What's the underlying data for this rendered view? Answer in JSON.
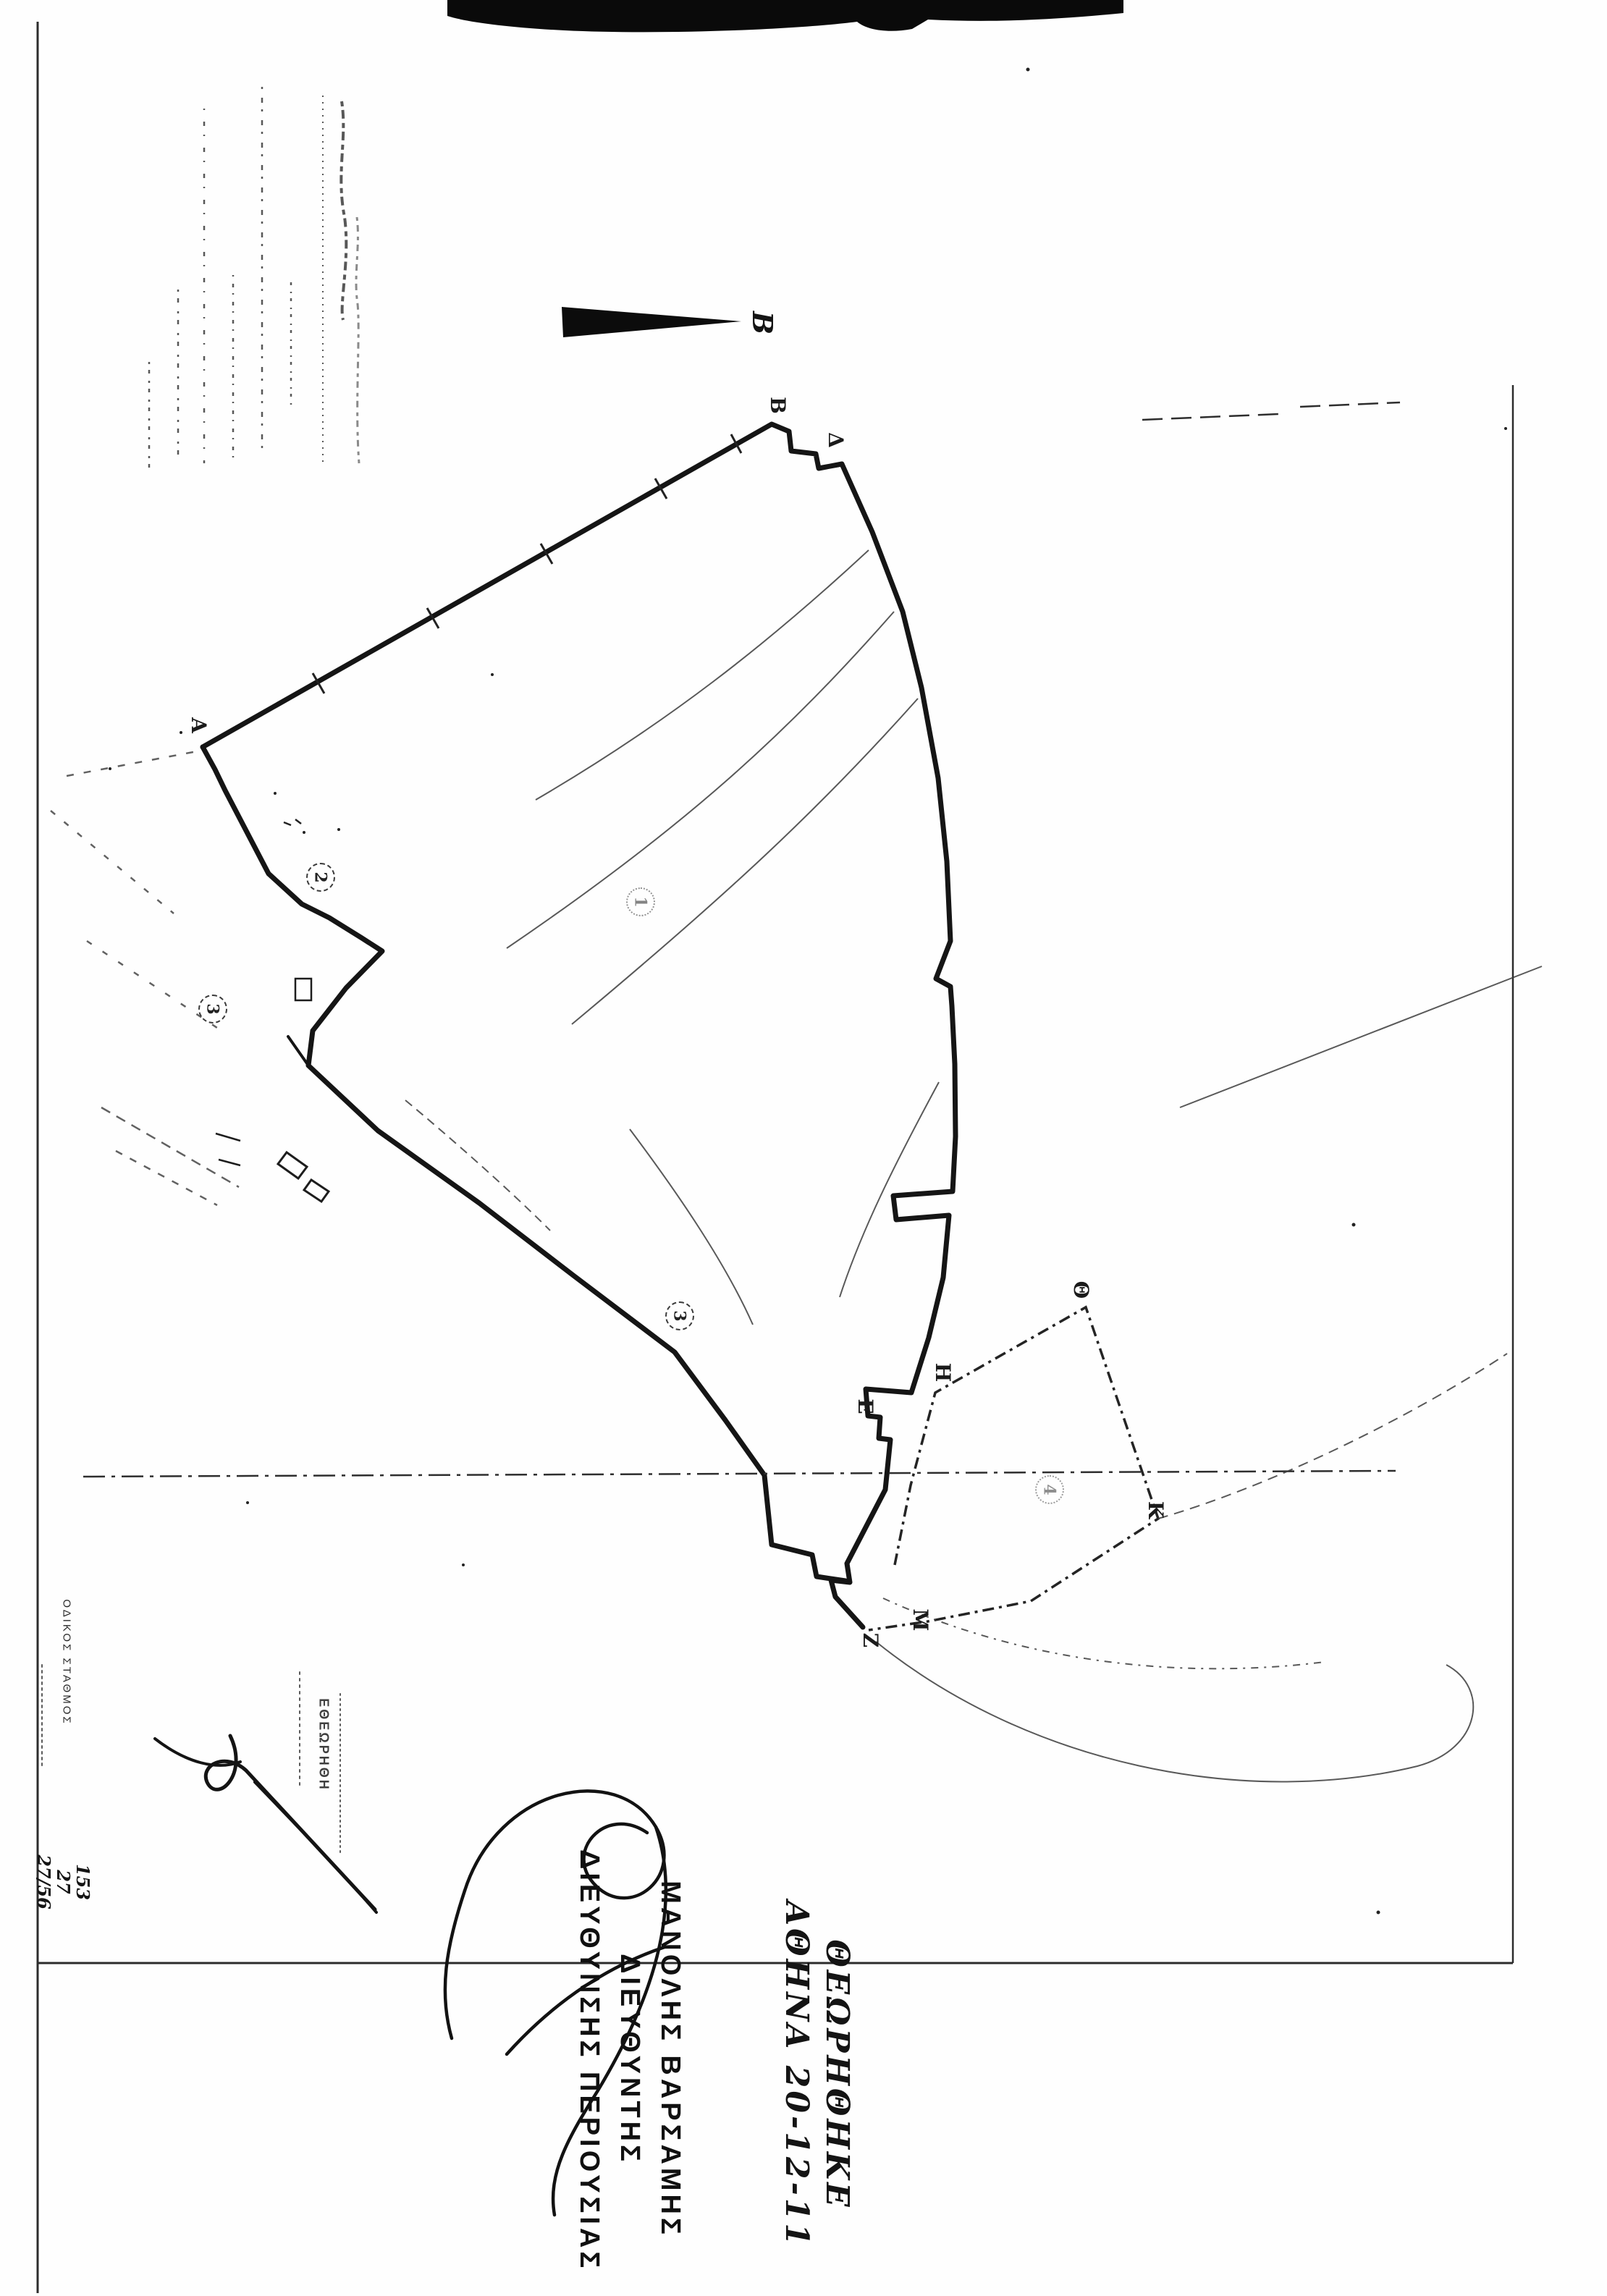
{
  "colors": {
    "ink": "#161616",
    "faint": "#4a4a4a",
    "paper": "#fefefe"
  },
  "map": {
    "north_arrow_label": "Β",
    "vertex_labels": {
      "alpha": "Α",
      "beta": "Β",
      "delta": "Δ",
      "epsilon": "Ε",
      "zeta": "Ζ",
      "eta": "Η",
      "theta": "Θ",
      "kappa": "Κ",
      "mu": "Μ"
    },
    "parcel_numbers": {
      "p1": "1",
      "p2": "2",
      "p3_left": "3",
      "p3_strip": "3",
      "p4": "4"
    }
  },
  "annotations": {
    "review_note": {
      "line1": "ΘΕΩΡΗΘΗΚΕ",
      "line2": "ΑΘΗΝΑ 20-12-11"
    },
    "officer": {
      "line1": "ΜΑΝΟΛΗΣ ΒΑΡΣΑΜΗΣ",
      "line2": "ΔΙΕΥΘΥΝΤΗΣ",
      "line3": "ΔΙΕΥΘΥΝΣΗΣ ΠΕΡΙΟΥΣΙΑΣ"
    },
    "stamp_word": "ΕΘΕΩΡΗΘΗ",
    "file_numbers": [
      "153",
      "27",
      "27/56"
    ],
    "margin_note": "ΟΔΙΚΟΣ ΣΤΑΘΜΟΣ"
  }
}
